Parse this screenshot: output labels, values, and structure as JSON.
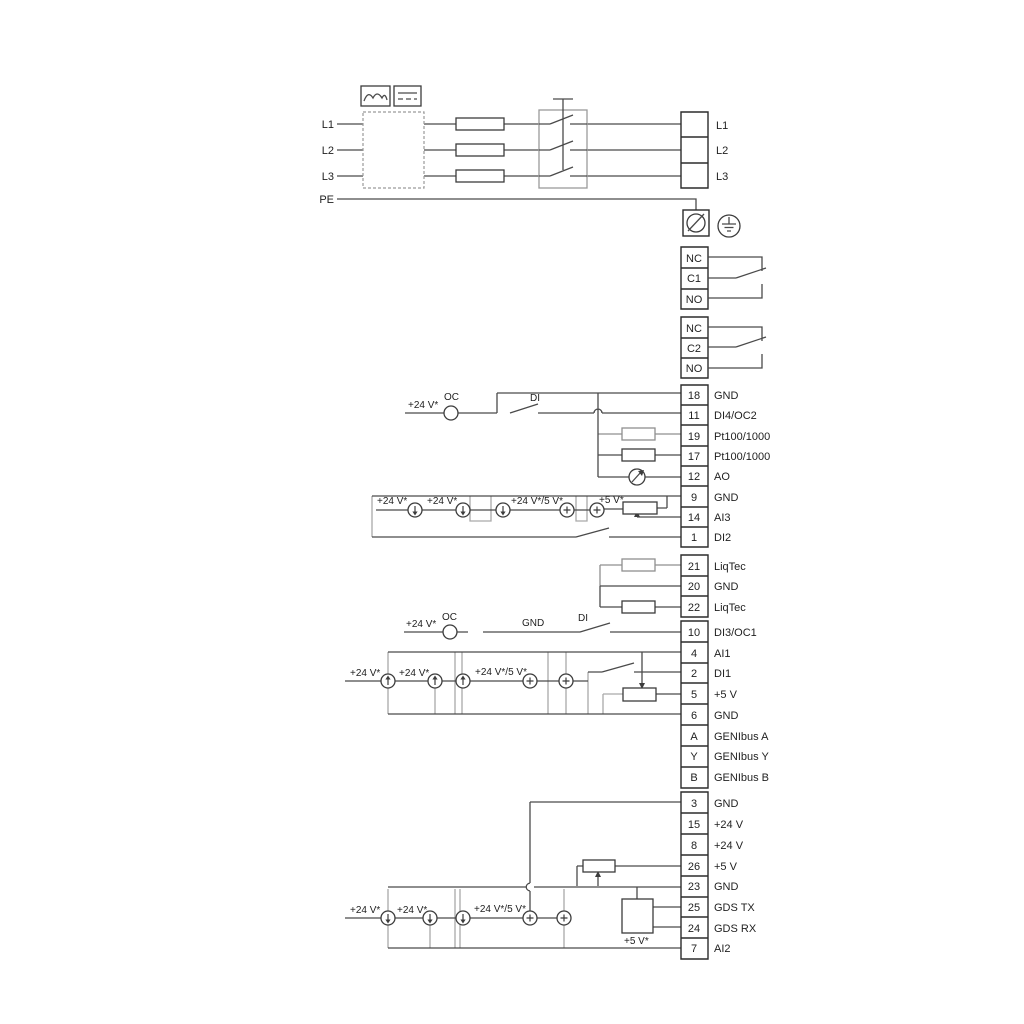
{
  "colors": {
    "wire": "#4a4a4a",
    "grey_wire": "#a9a9a9",
    "text": "#1f1f1f",
    "background": "#ffffff"
  },
  "top": {
    "input_labels": [
      "L1",
      "L2",
      "L3",
      "PE"
    ],
    "output_labels": [
      "L1",
      "L2",
      "L3"
    ]
  },
  "relays": [
    {
      "rows": [
        "NC",
        "C1",
        "NO"
      ]
    },
    {
      "rows": [
        "NC",
        "C2",
        "NO"
      ]
    }
  ],
  "terminal_groups": [
    {
      "id": "io-top",
      "rows": [
        {
          "num": "18",
          "label": "GND"
        },
        {
          "num": "11",
          "label": "DI4/OC2"
        },
        {
          "num": "19",
          "label": "Pt100/1000"
        },
        {
          "num": "17",
          "label": "Pt100/1000"
        },
        {
          "num": "12",
          "label": "AO"
        },
        {
          "num": "9",
          "label": "GND"
        },
        {
          "num": "14",
          "label": "AI3"
        },
        {
          "num": "1",
          "label": "DI2"
        }
      ]
    },
    {
      "id": "liqtec",
      "rows": [
        {
          "num": "21",
          "label": "LiqTec"
        },
        {
          "num": "20",
          "label": "GND"
        },
        {
          "num": "22",
          "label": "LiqTec"
        }
      ]
    },
    {
      "id": "io-mid",
      "rows": [
        {
          "num": "10",
          "label": "DI3/OC1"
        },
        {
          "num": "4",
          "label": "AI1"
        },
        {
          "num": "2",
          "label": "DI1"
        },
        {
          "num": "5",
          "label": "+5 V"
        },
        {
          "num": "6",
          "label": "GND"
        },
        {
          "num": "A",
          "label": "GENIbus A"
        },
        {
          "num": "Y",
          "label": "GENIbus Y"
        },
        {
          "num": "B",
          "label": "GENIbus B"
        }
      ]
    },
    {
      "id": "io-bottom",
      "rows": [
        {
          "num": "3",
          "label": "GND"
        },
        {
          "num": "15",
          "label": "+24 V"
        },
        {
          "num": "8",
          "label": "+24 V"
        },
        {
          "num": "26",
          "label": "+5 V"
        },
        {
          "num": "23",
          "label": "GND"
        },
        {
          "num": "25",
          "label": "GDS TX"
        },
        {
          "num": "24",
          "label": "GDS RX"
        },
        {
          "num": "7",
          "label": "AI2"
        }
      ]
    }
  ],
  "annotations": {
    "v24": "+24 V*",
    "v24or5": "+24 V*/5 V*",
    "v5": "+5 V*",
    "oc": "OC",
    "di": "DI",
    "gnd": "GND"
  }
}
